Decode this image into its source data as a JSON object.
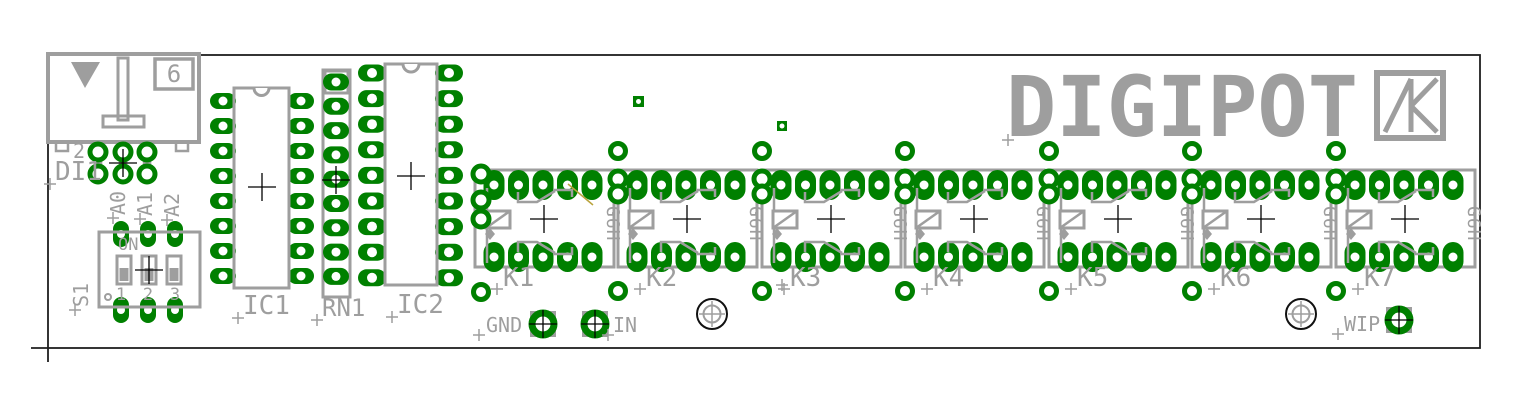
{
  "board": {
    "brand_text": "DIGIPOT",
    "silkscreen_color": "#9e9e9e",
    "pad_color": "#008000",
    "outline_color": "#1f1f1f",
    "ratsnest_color": "#b9a33c"
  },
  "connector": {
    "ref": "DI1",
    "pin2_label": "2",
    "cavity_label": "6"
  },
  "jumpers": {
    "labels": [
      "A0",
      "A1",
      "A2"
    ]
  },
  "dip_switch": {
    "ref": "S1",
    "on_label": "ON",
    "position_labels": [
      "1",
      "2",
      "3"
    ]
  },
  "ics": {
    "ic1_ref": "IC1",
    "rn1_ref": "RN1",
    "ic2_ref": "IC2"
  },
  "relays": {
    "refs": [
      "K1",
      "K2",
      "K3",
      "K4",
      "K5",
      "K6",
      "K7"
    ],
    "type_label": "G6H"
  },
  "test_points": {
    "gnd_label": "GND",
    "in_label": "IN",
    "wip_label": "WIP"
  }
}
